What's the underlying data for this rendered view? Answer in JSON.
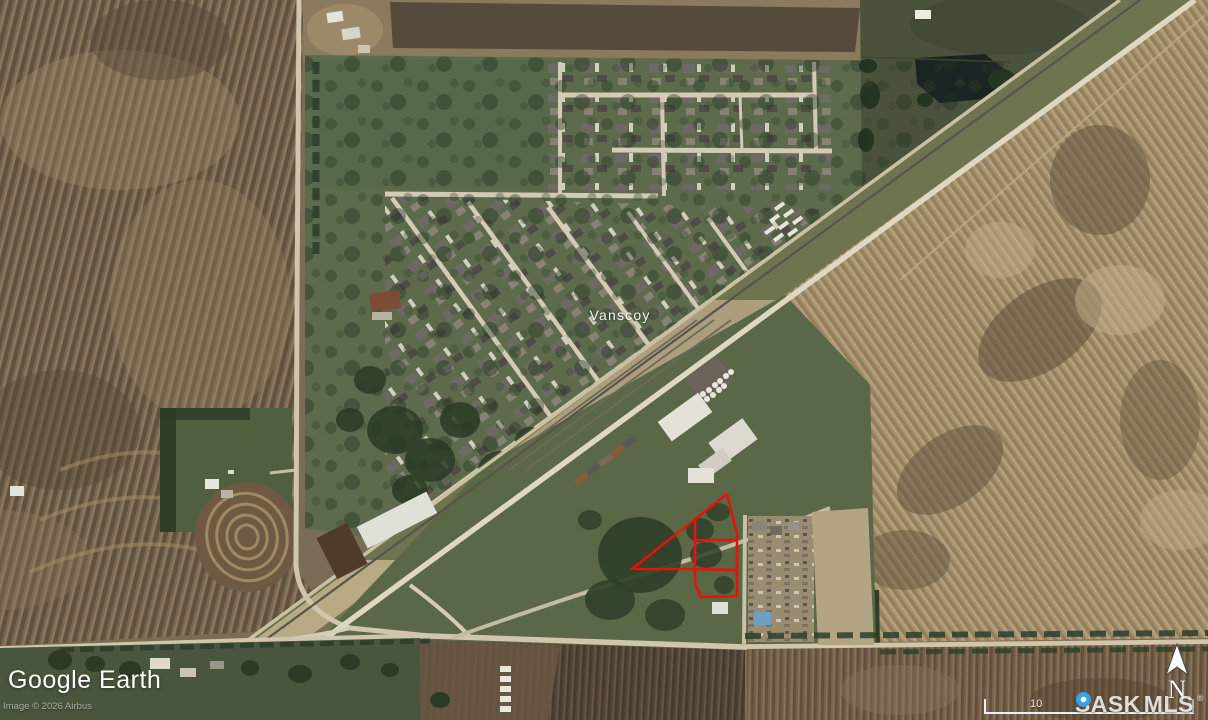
{
  "map": {
    "place_label": "Vanscoy",
    "watermark": "Google Earth",
    "attribution": "Image © 2026 Airbus",
    "scale_label": "10",
    "compass_label": "N",
    "logo": {
      "part1": "SASK",
      "part2": "MLS",
      "registered": "®",
      "pin_color": "#35a3e8"
    },
    "annotation": {
      "stroke_color": "#e8120b",
      "outline_points": "727,494 632,569 695,569 695,584 701,597 737,596 737,534",
      "inner_vertical_points": "695,518 695,569",
      "inner_divider1_points": "695,540 737,540",
      "inner_divider2_points": "695,569 737,570"
    }
  }
}
